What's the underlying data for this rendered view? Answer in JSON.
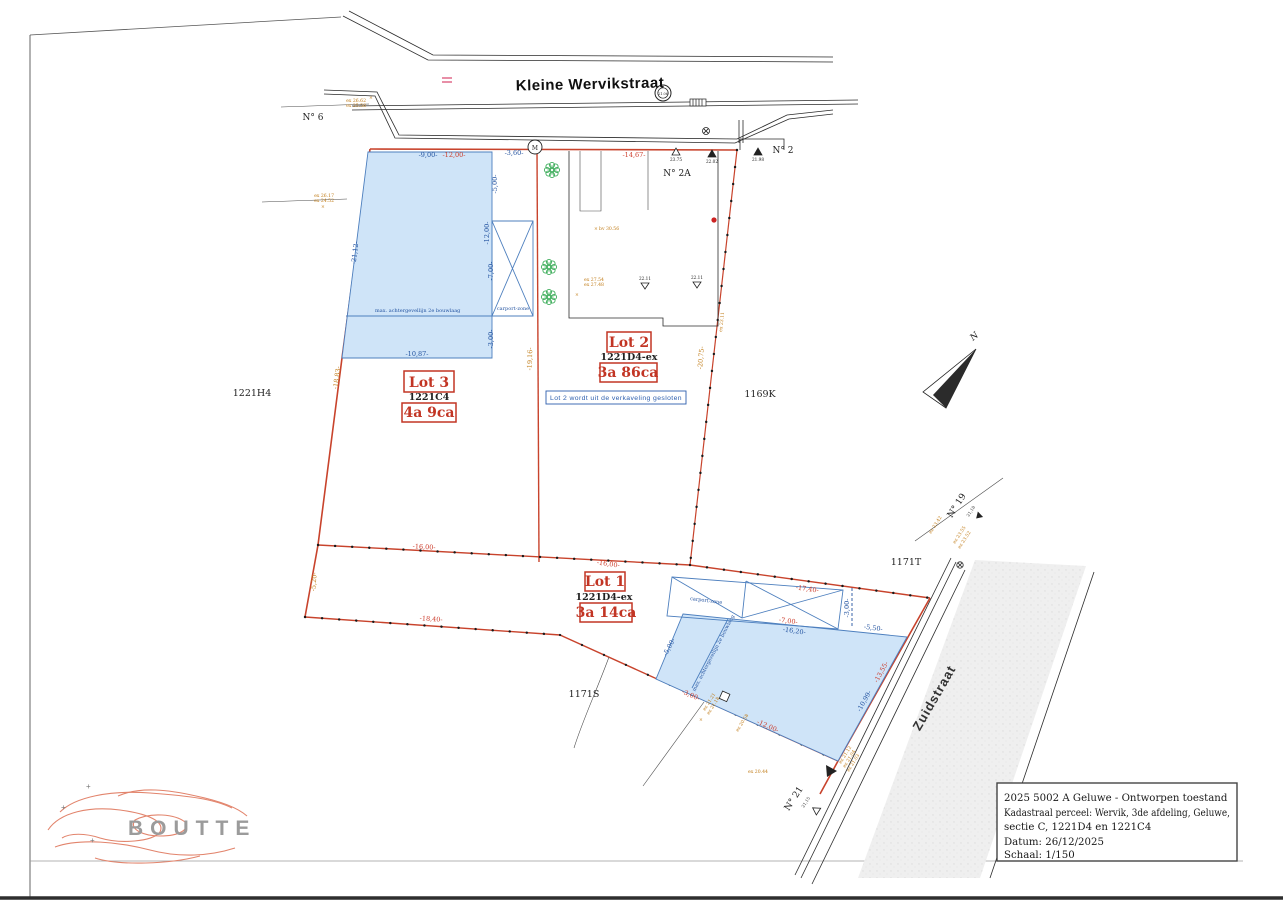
{
  "plan": {
    "streets": {
      "kleine_wervikstraat": "Kleine Wervikstraat",
      "zuidstraat": "Zuidstraat"
    },
    "house_numbers": {
      "n6": "N° 6",
      "n2": "N° 2",
      "n2a": "N° 2A",
      "n19": "N° 19",
      "n21": "N° 21"
    },
    "parcels": {
      "p1221h4": "1221H4",
      "p1169k": "1169K",
      "p1171t": "1171T",
      "p1171s": "1171S"
    },
    "lot3": {
      "label": "Lot 3",
      "parcel": "1221C4",
      "area": "4a 9ca"
    },
    "lot2": {
      "label": "Lot 2",
      "parcel": "1221D4-ex",
      "area": "3a 86ca",
      "note": "Lot 2 wordt uit de verkaveling gesloten"
    },
    "lot1": {
      "label": "Lot 1",
      "parcel": "1221D4-ex",
      "area": "3a 14ca"
    },
    "zone_labels": {
      "backline": "max. achtergevellijn 2e bouwlaag",
      "carport": "carport-zone"
    },
    "north": "N",
    "monument": "M",
    "dims": {
      "top9": "-9,00-",
      "top12": "-12,00-",
      "gap360": "-3,60-",
      "lot2top": "-14,67-",
      "z3_5": "-5,00-",
      "z3_12": "-12,00-",
      "z3_7": "-7,00-",
      "z3_3": "-3,00-",
      "z3_b": "-10,87-",
      "lot3w": "-21,12-",
      "lot3we": "-18,83-",
      "divider": "-19,16-",
      "lot2e": "-20,75-",
      "fence16a": "-16,00-",
      "fence16b": "-16,00-",
      "lot1w": "-5,20-",
      "diag1840": "-18,40-",
      "c1w": "-17,40-",
      "c1d": "-7,00-",
      "z1top": "-16,20-",
      "z1_550": "-5,50-",
      "z1_300": "-3,00-",
      "z1left": "-5,00-",
      "s300": "-3,00-",
      "s1200": "-12,00-",
      "z1east": "-10,99-",
      "se1355": "-13,55-"
    },
    "levels": {
      "l2662": "ex 26.62",
      "l2558": "ex 25.58",
      "l2617": "ex 26.17",
      "l2452": "ex 24.52",
      "l2754": "ex 27.54",
      "l2748": "ex 27.48",
      "bv": "bv 30.56",
      "l2311": "ex 23.11",
      "l2342": "ex 23.42",
      "l2355": "ex 23.55",
      "l2352": "ex 23.52",
      "l2112": "ex 21.12",
      "l2104": "ex 21.04",
      "l2103": "ex 21.03",
      "l2044": "ex 20.44",
      "l2121": "ex 21.21",
      "l2118": "ex 21.18",
      "l2058": "ex 20.58",
      "t2375": "23.75",
      "t2202": "22.02",
      "t2198": "21.98",
      "t2211a": "22.11",
      "t2211b": "22.11",
      "t2118": "21,18",
      "t2115": "21,15",
      "mh": "21.06",
      "xmark": "×"
    },
    "logo": "BOUTTE",
    "titleblock": {
      "line1": "2025 5002 A Geluwe - Ontworpen toestand",
      "line2": "Kadastraal perceel: Wervik, 3de afdeling, Geluwe,",
      "line3": "sectie C, 1221D4 en 1221C4",
      "line4": "Datum: 26/12/2025",
      "line5": "Schaal: 1/150"
    }
  }
}
